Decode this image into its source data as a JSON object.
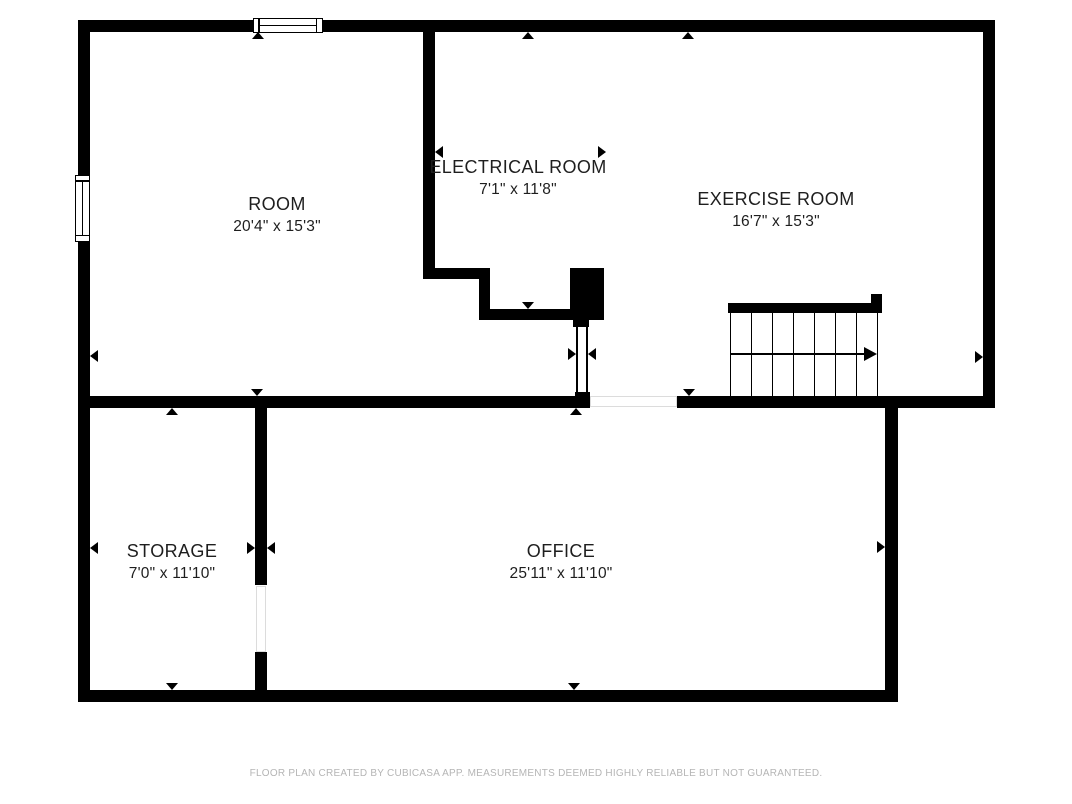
{
  "colors": {
    "wall": "#000000",
    "room_label": "#1e1e1e",
    "disclaimer_text": "#b5b5b5",
    "background": "#ffffff"
  },
  "rooms": [
    {
      "name": "ROOM",
      "dimensions": "20'4\" x 15'3\""
    },
    {
      "name": "ELECTRICAL ROOM",
      "dimensions": "7'1\" x 11'8\""
    },
    {
      "name": "EXERCISE ROOM",
      "dimensions": "16'7\" x 15'3\""
    },
    {
      "name": "STORAGE",
      "dimensions": "7'0\" x 11'10\""
    },
    {
      "name": "OFFICE",
      "dimensions": "25'11\" x 11'10\""
    }
  ],
  "symbols": {
    "windows": [
      "window-top-wall",
      "window-left-wall"
    ],
    "staircase": {
      "treads": 7,
      "direction": "right"
    }
  },
  "footer": {
    "disclaimer": "FLOOR PLAN CREATED BY CUBICASA APP. MEASUREMENTS DEEMED HIGHLY RELIABLE BUT NOT GUARANTEED."
  }
}
